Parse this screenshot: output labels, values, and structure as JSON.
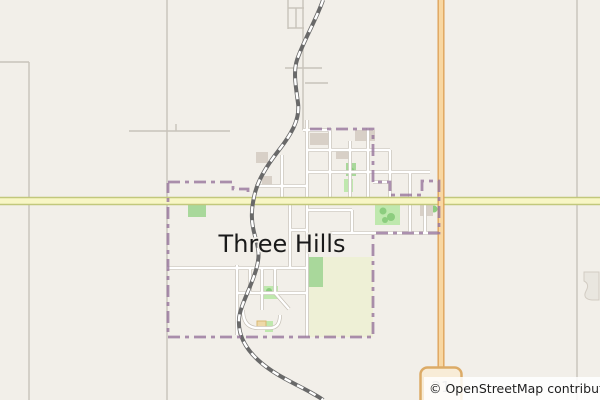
{
  "map": {
    "town_label": {
      "text": "Three Hills"
    },
    "attribution": {
      "text": "© OpenStreetMap contributors"
    },
    "shield": {
      "ref": "21"
    },
    "colors": {
      "background": "#f2efe9",
      "rural_road": "#c8c3ba",
      "town_road_casing": "#c6c0b6",
      "town_road_fill": "#ffffff",
      "primary_yellow_casing": "#c2c87c",
      "primary_yellow_fill": "#f8f6c5",
      "trunk_orange_casing": "#dc9f55",
      "trunk_orange_fill": "#f8d7a2",
      "railway_dark": "#696969",
      "railway_dash": "#ffffff",
      "boundary_purple": "#96749b",
      "park_green": "#bfe8ae",
      "scrub_green": "#a9d89b",
      "tree_green": "#8ccd7f",
      "field_pale": "#eef0d6",
      "building_grey": "#d8d0c7",
      "building_tan": "#eed9a9",
      "building_tan_border": "#d8b873",
      "pit_fill": "#e9e6df",
      "pit_stroke": "#d2ccc3",
      "shield_fill": "#f8ecd7",
      "shield_border": "#dcab67",
      "shield_text": "#8f8f8f",
      "label_color": "#1a1a1a",
      "attribution_bg": "rgba(255,255,255,0.85)",
      "attribution_color": "#1f1f1f"
    },
    "layers": [
      {
        "name": "landuse-field",
        "kind": "rect",
        "style": {
          "fill": "field_pale"
        },
        "items": [
          {
            "x": 306,
            "y": 257,
            "w": 67,
            "h": 80
          }
        ]
      },
      {
        "name": "landuse-scrub",
        "kind": "rect",
        "style": {
          "fill": "scrub_green"
        },
        "items": [
          {
            "x": 306,
            "y": 257,
            "w": 17,
            "h": 30
          },
          {
            "x": 188,
            "y": 202,
            "w": 18,
            "h": 15
          },
          {
            "x": 346,
            "y": 163,
            "w": 10,
            "h": 13
          }
        ]
      },
      {
        "name": "landuse-park",
        "kind": "rect",
        "style": {
          "fill": "park_green"
        },
        "items": [
          {
            "x": 375,
            "y": 204,
            "w": 25,
            "h": 21
          },
          {
            "x": 344,
            "y": 179,
            "w": 9,
            "h": 13
          },
          {
            "x": 263,
            "y": 286,
            "w": 15,
            "h": 13
          },
          {
            "x": 265,
            "y": 321,
            "w": 8,
            "h": 11
          }
        ]
      },
      {
        "name": "tree",
        "kind": "circle",
        "style": {
          "fill": "tree_green"
        },
        "items": [
          {
            "cx": 383,
            "cy": 211,
            "r": 3.5
          },
          {
            "cx": 391,
            "cy": 217,
            "r": 4
          },
          {
            "cx": 385,
            "cy": 220,
            "r": 3
          },
          {
            "cx": 351,
            "cy": 171,
            "r": 3.5
          },
          {
            "cx": 434,
            "cy": 209,
            "r": 3.5
          },
          {
            "cx": 269,
            "cy": 291,
            "r": 3
          }
        ]
      },
      {
        "name": "pit-area",
        "kind": "path",
        "style": {
          "fill": "pit_fill",
          "stroke": "pit_stroke",
          "width": 1
        },
        "items": [
          "M584,272 h15 v28 h-7 q-10,-1 -6,-9 q4,-7 -2,-10 z"
        ]
      },
      {
        "name": "building",
        "kind": "rect",
        "style": {
          "fill": "building_grey"
        },
        "items": [
          {
            "x": 310,
            "y": 133,
            "w": 20,
            "h": 12
          },
          {
            "x": 355,
            "y": 130,
            "w": 20,
            "h": 11
          },
          {
            "x": 336,
            "y": 150,
            "w": 15,
            "h": 9
          },
          {
            "x": 420,
            "y": 203,
            "w": 13,
            "h": 13
          },
          {
            "x": 256,
            "y": 152,
            "w": 12,
            "h": 11
          },
          {
            "x": 262,
            "y": 176,
            "w": 10,
            "h": 9
          }
        ]
      },
      {
        "name": "building-tan",
        "kind": "rect",
        "style": {
          "fill": "building_tan",
          "stroke": "building_tan_border",
          "width": 1
        },
        "items": [
          {
            "x": 257,
            "y": 321,
            "w": 9,
            "h": 8
          }
        ]
      },
      {
        "name": "rural-road",
        "kind": "path",
        "style": {
          "stroke": "rural_road",
          "width": 1.4,
          "fill": "none"
        },
        "items": [
          "M0,62 H29",
          "M29,62 V400",
          "M167,0 V400",
          "M129,131 H230",
          "M176,124 V131",
          "M577,0 V400",
          "M303,0 V130",
          "M285,68 H322",
          "M305,83 H328",
          "M288,0 V29",
          "M296,8 V28",
          "M288,8 H304",
          "M288,28 H304"
        ]
      },
      {
        "name": "town-road",
        "kind": "path",
        "passes": [
          {
            "stroke": "town_road_casing",
            "width": 3.8,
            "fill": "none"
          },
          {
            "stroke": "town_road_fill",
            "width": 2.4,
            "fill": "none"
          }
        ],
        "items": [
          "M307,120 V337",
          "M330,128 V197",
          "M350,141 V197",
          "M368,128 V197",
          "M390,150 V197",
          "M410,172 V233",
          "M425,197 V233",
          "M282,155 V197",
          "M303,130 H330",
          "M307,150 H390",
          "M307,172 H430",
          "M255,186 H307",
          "M307,210 H352",
          "M352,210 V233",
          "M330,233 H440",
          "M373,182 H390",
          "M167,268 H307",
          "M237,265 V335",
          "M237,293 H307",
          "M250,268 V293",
          "M262,268 V310",
          "M275,268 V293",
          "M290,197 V268",
          "M290,230 H307",
          "M243,310 Q243,328 258,328 H270 Q280,328 280,315",
          "M275,293 L289,309"
        ]
      },
      {
        "name": "highway-yellow",
        "kind": "path",
        "passes": [
          {
            "stroke": "primary_yellow_casing",
            "width": 8.5,
            "fill": "none"
          },
          {
            "stroke": "primary_yellow_fill",
            "width": 5.5,
            "fill": "none"
          }
        ],
        "items": [
          "M0,201 H600"
        ]
      },
      {
        "name": "highway-orange",
        "kind": "path",
        "passes": [
          {
            "stroke": "trunk_orange_casing",
            "width": 7,
            "fill": "none"
          },
          {
            "stroke": "trunk_orange_fill",
            "width": 4.4,
            "fill": "none"
          }
        ],
        "items": [
          "M441,0 V400"
        ]
      },
      {
        "name": "railway",
        "kind": "path",
        "passes": [
          {
            "stroke": "railway_dark",
            "width": 4,
            "fill": "none"
          },
          {
            "stroke": "railway_dash",
            "width": 2.4,
            "dash": "7 7",
            "fill": "none"
          }
        ],
        "items": [
          "M323,0 C317,18 303,42 297,60 C293,72 296,88 298,103 C300,118 293,132 279,150 C265,168 257,182 254,197 C251,211 251,222 255,236 C259,250 260,256 256,270 C250,290 240,306 239,319 C238,333 244,347 258,360 C274,375 296,384 310,392 C317,396 321,398 323,400"
        ]
      },
      {
        "name": "town-boundary",
        "kind": "path",
        "style": {
          "stroke": "boundary_purple",
          "width": 2.8,
          "dash": "12 5 4 5",
          "opacity": 0.8,
          "fill": "none"
        },
        "items": [
          "M168,182 H233 V189 H248 V197",
          "M310,129 H373 V182 H390 V195 H422 V181 H439 V233 H373 V337 H168 V183"
        ]
      }
    ]
  }
}
